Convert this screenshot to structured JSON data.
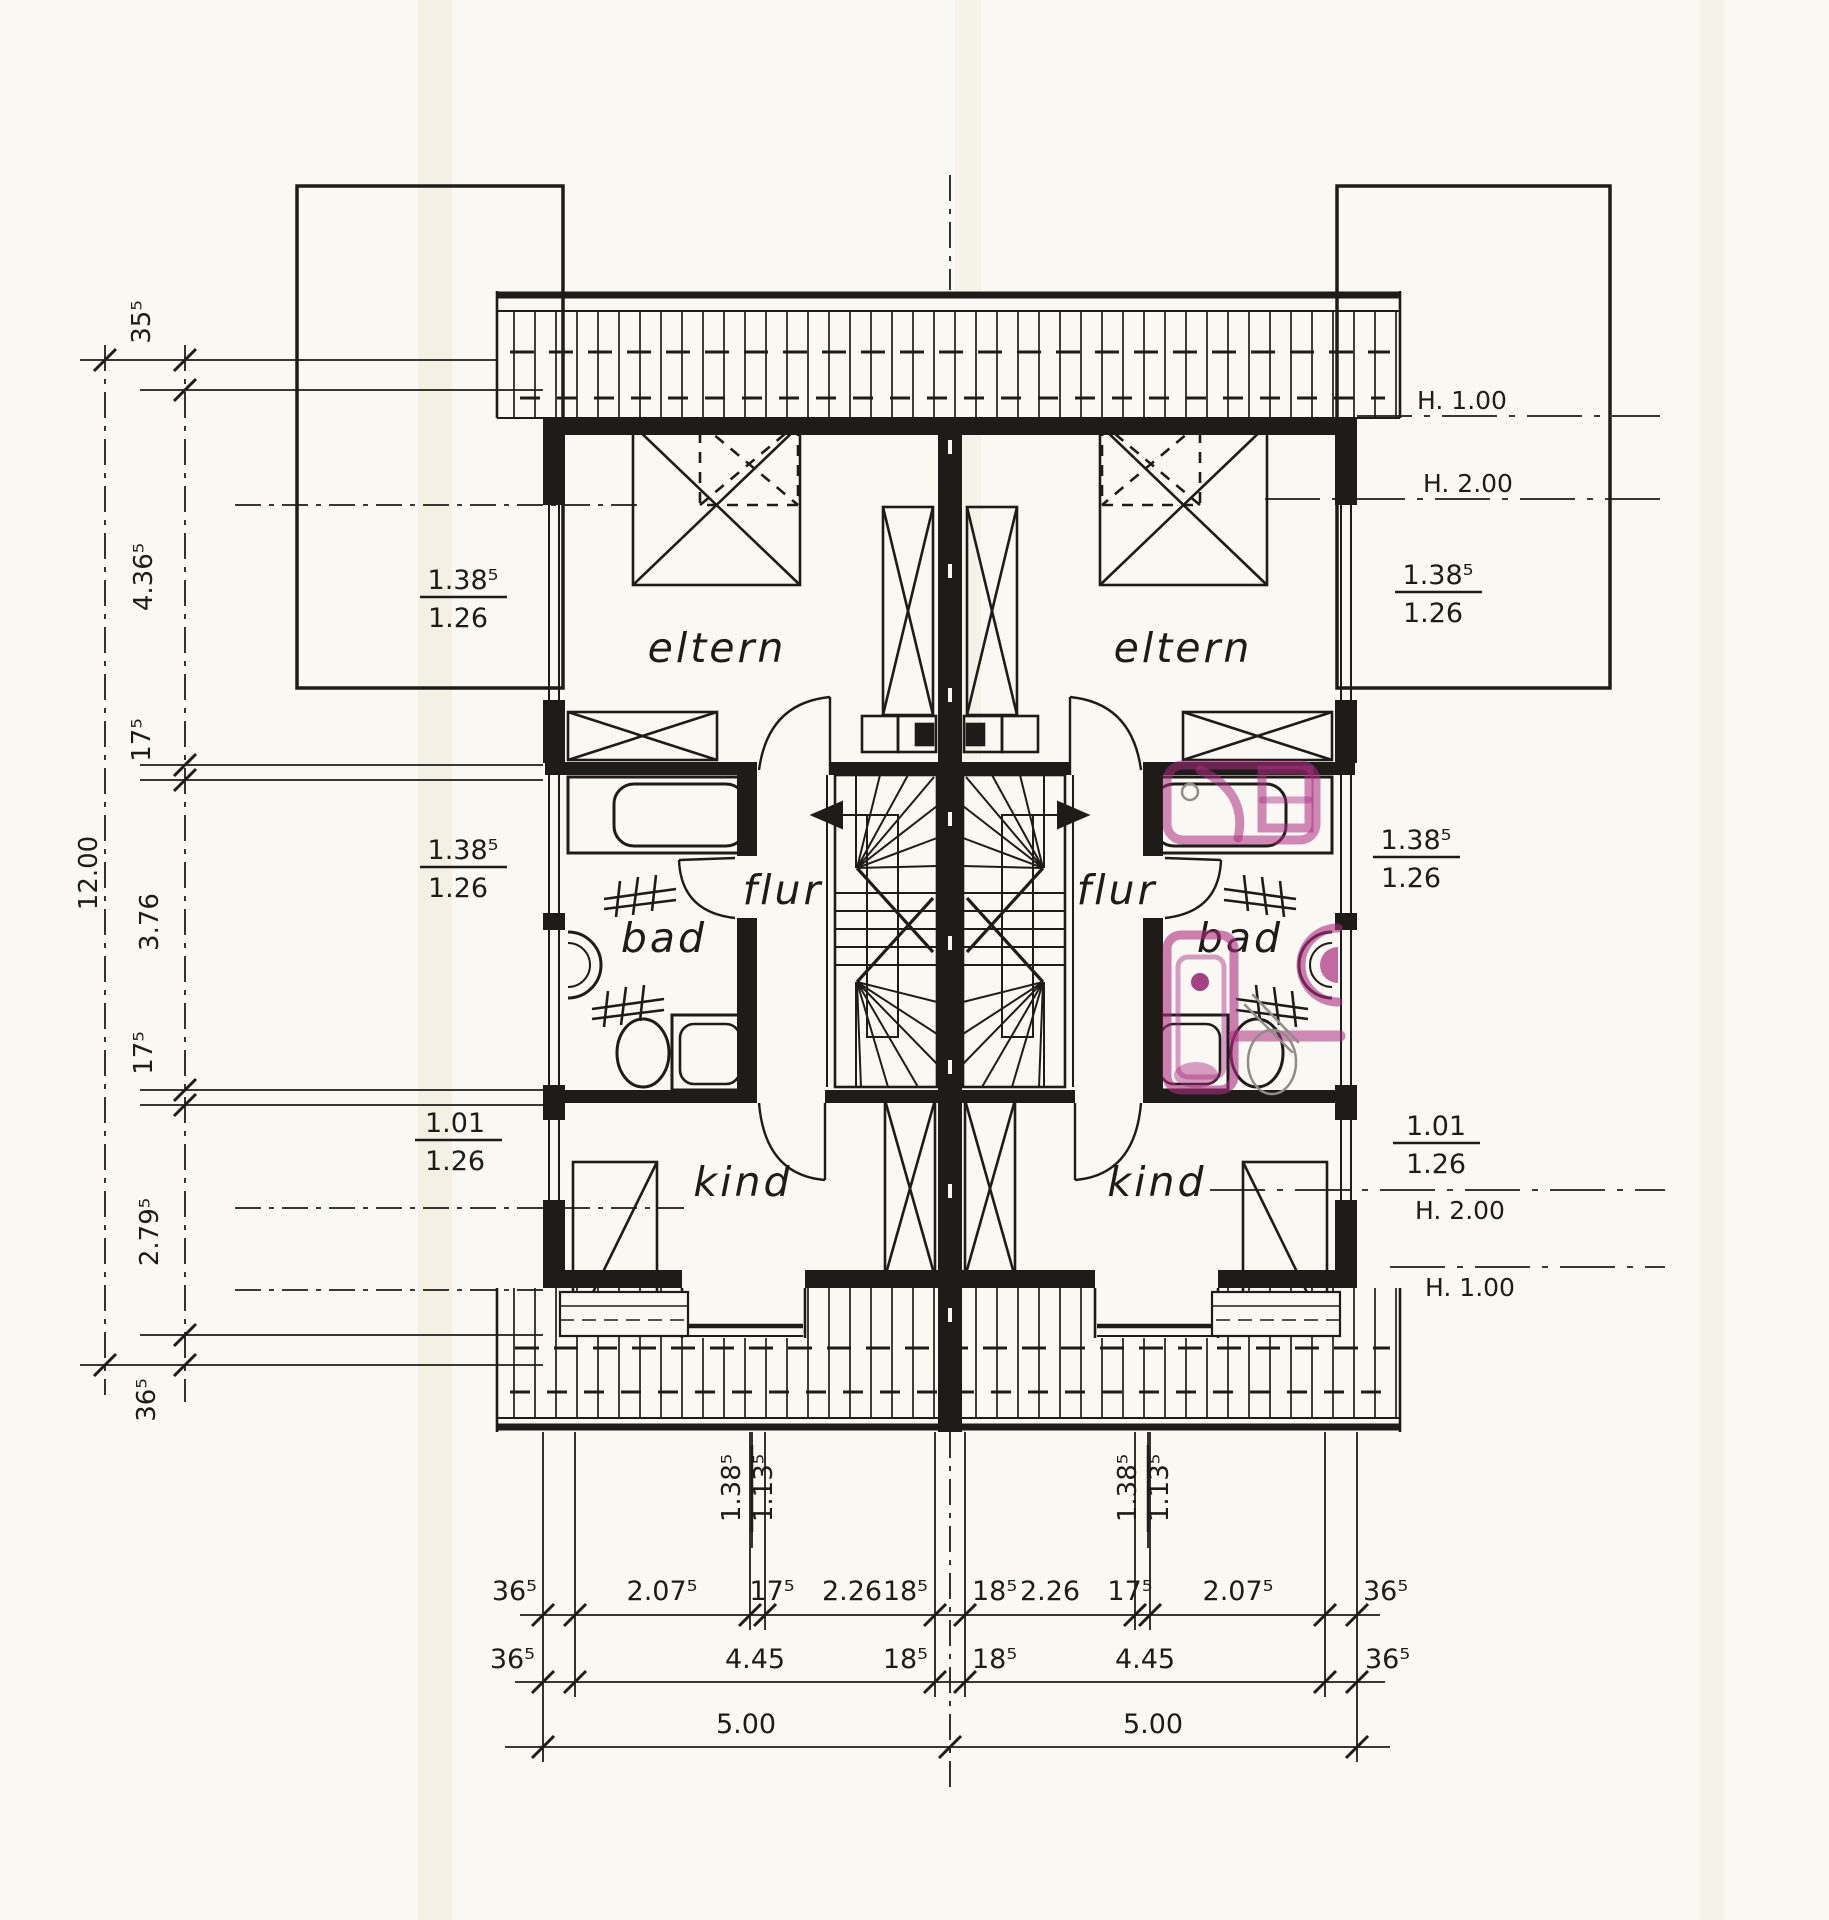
{
  "rooms": {
    "eltern": "eltern",
    "flur": "flur",
    "bad": "bad",
    "kind": "kind"
  },
  "dims": {
    "left": {
      "overall": "12.00",
      "chain": [
        "35⁵",
        "4.36⁵",
        "17⁵",
        "3.76",
        "17⁵",
        "2.79⁵",
        "36⁵"
      ]
    },
    "bottom": {
      "row1": [
        "36⁵",
        "2.07⁵",
        "17⁵",
        "2.26",
        "18⁵",
        "18⁵",
        "2.26",
        "17⁵",
        "2.07⁵",
        "36⁵"
      ],
      "row2": [
        "36⁵",
        "4.45",
        "18⁵",
        "18⁵",
        "4.45",
        "36⁵"
      ],
      "row3": [
        "5.00",
        "5.00"
      ]
    }
  },
  "window_labels": {
    "left": [
      {
        "top": "1.38⁵",
        "bottom": "1.26"
      },
      {
        "top": "1.38⁵",
        "bottom": "1.26"
      },
      {
        "top": "1.01",
        "bottom": "1.26"
      }
    ],
    "right": [
      {
        "top": "1.38⁵",
        "bottom": "1.26"
      },
      {
        "top": "1.38⁵",
        "bottom": "1.26"
      },
      {
        "top": "1.01",
        "bottom": "1.26"
      }
    ],
    "bottom_rotated": [
      {
        "top": "1.38⁵",
        "bottom": "1.13⁵"
      },
      {
        "top": "1.38⁵",
        "bottom": "1.13⁵"
      }
    ]
  },
  "height_lines": {
    "top": [
      "H. 1.00",
      "H. 2.00"
    ],
    "bottom": [
      "H. 2.00",
      "H. 1.00"
    ]
  },
  "colors": {
    "paper": "#f9f8f2",
    "ink": "#1d1c18",
    "marker": "#ab2c80",
    "pencil": "#8f8d89"
  }
}
